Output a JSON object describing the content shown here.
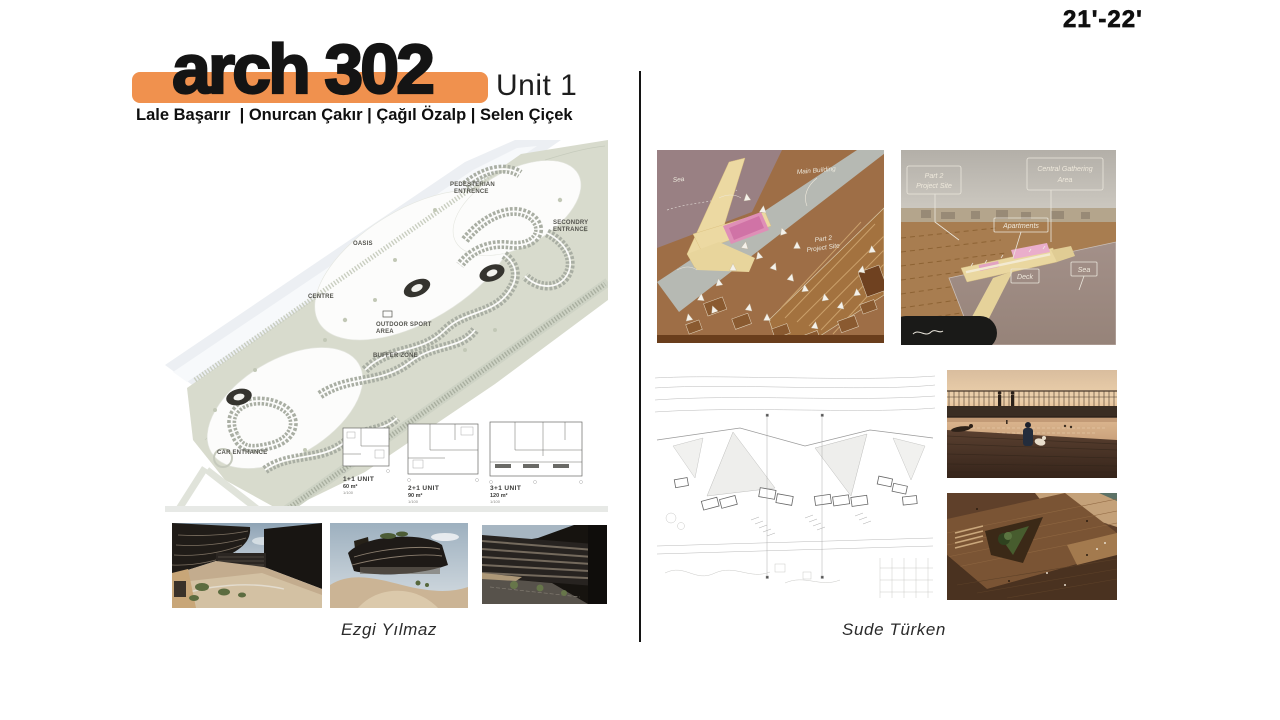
{
  "page": {
    "year_label": "21'-22'",
    "background": "#ffffff"
  },
  "header": {
    "course_title": "arch 302",
    "unit_label": "Unit 1",
    "instructors": "Lale Başarır  | Onurcan Çakır | Çağıl Özalp | Selen Çiçek",
    "banner_color": "#F0914E"
  },
  "left_project": {
    "student_name": "Ezgi Yılmaz",
    "site_plan_labels": {
      "pedestrian_entrance": {
        "line1": "PEDESTERIAN",
        "line2": "ENTRENCE"
      },
      "secondary_entrance": {
        "line1": "SECONDRY",
        "line2": "ENTRANCE"
      },
      "oasis": "OASIS",
      "centre": "CENTRE",
      "outdoor_sport": {
        "line1": "OUTDOOR SPORT",
        "line2": "AREA"
      },
      "buffer_zone": "BUFFER ZONE",
      "car_entrance": "CAR ENTRANCE"
    },
    "unit_plans": [
      {
        "name": "1+1 UNIT",
        "area": "60 m²",
        "scale": "1/100"
      },
      {
        "name": "2+1 UNIT",
        "area": "90 m²",
        "scale": "1/100"
      },
      {
        "name": "3+1 UNIT",
        "area": "120 m²",
        "scale": "1/100"
      }
    ]
  },
  "right_project": {
    "student_name": "Sude Türken",
    "model_top_annotations": {
      "sea": "Sea",
      "main_building": "Main Building",
      "project_site": {
        "line1": "Part 2",
        "line2": "Project Site"
      }
    },
    "model_perspective_annotations": {
      "project_site": {
        "line1": "Part 2",
        "line2": "Project Site"
      },
      "gathering": {
        "line1": "Central Gathering",
        "line2": "Area"
      },
      "apartments": "Apartments",
      "deck": "Deck",
      "sea": "Sea"
    }
  }
}
